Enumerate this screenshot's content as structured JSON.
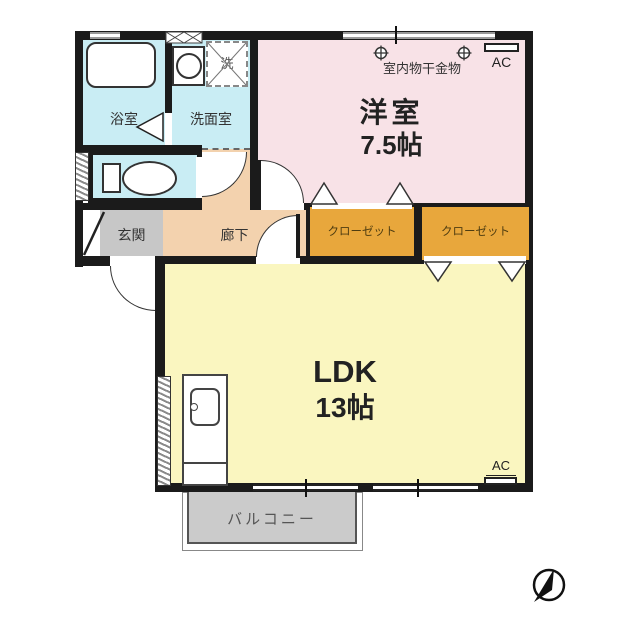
{
  "plan": {
    "rooms": {
      "bathroom": {
        "label": "浴室"
      },
      "washroom": {
        "label": "洗面室"
      },
      "washer": {
        "label": "洗"
      },
      "western_room": {
        "label": "洋室",
        "size": "7.5帖"
      },
      "genkan": {
        "label": "玄関"
      },
      "corridor": {
        "label": "廊下"
      },
      "closet_left": {
        "label": "クローゼット"
      },
      "closet_right": {
        "label": "クローゼット"
      },
      "ldk": {
        "label": "LDK",
        "size": "13帖"
      },
      "balcony": {
        "label": "バルコニー"
      }
    },
    "annotations": {
      "laundry_hardware_label": "室内物干金物",
      "ac_unit_top": "AC",
      "ac_unit_bottom": "AC"
    },
    "colors": {
      "wet_area": "#c9edf4",
      "western_room": "#f8e2e7",
      "corridor": "#f3d2ae",
      "genkan": "#c7c7c7",
      "closet": "#e8a73c",
      "ldk": "#faf6c0",
      "balcony": "#cbcbcb",
      "wall": "#1b1b1b"
    }
  }
}
